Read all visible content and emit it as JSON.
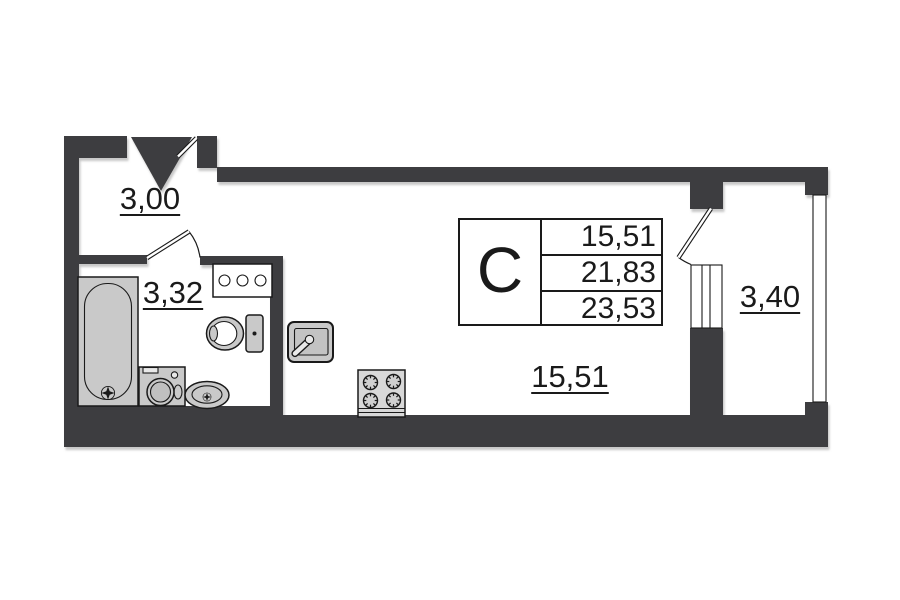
{
  "floor_plan": {
    "dimensions": {
      "hallway": "3,00",
      "bathroom": "3,32",
      "living_room": "15,51",
      "balcony": "3,40"
    },
    "area_table": {
      "unit_type": "С",
      "rows": [
        "15,51",
        "21,83",
        "23,53"
      ]
    },
    "fixtures": [
      "entrance-arrow-icon",
      "entrance-door-leaf",
      "bathtub",
      "washing-machine",
      "pedestal-sink",
      "toilet",
      "bathroom-shelf",
      "bathroom-door",
      "kitchen-sink",
      "stove",
      "balcony-door",
      "balcony-window",
      "outer-window"
    ],
    "colors": {
      "wall": "#3e3e40",
      "fixture": "#c9c9c9",
      "fixture_inner": "#c0c0c0",
      "stove": "#d8d8d8",
      "burner": "#d0d0d0",
      "white": "#ffffff",
      "outline": "#1a1a1a",
      "background": "#ffffff"
    }
  }
}
